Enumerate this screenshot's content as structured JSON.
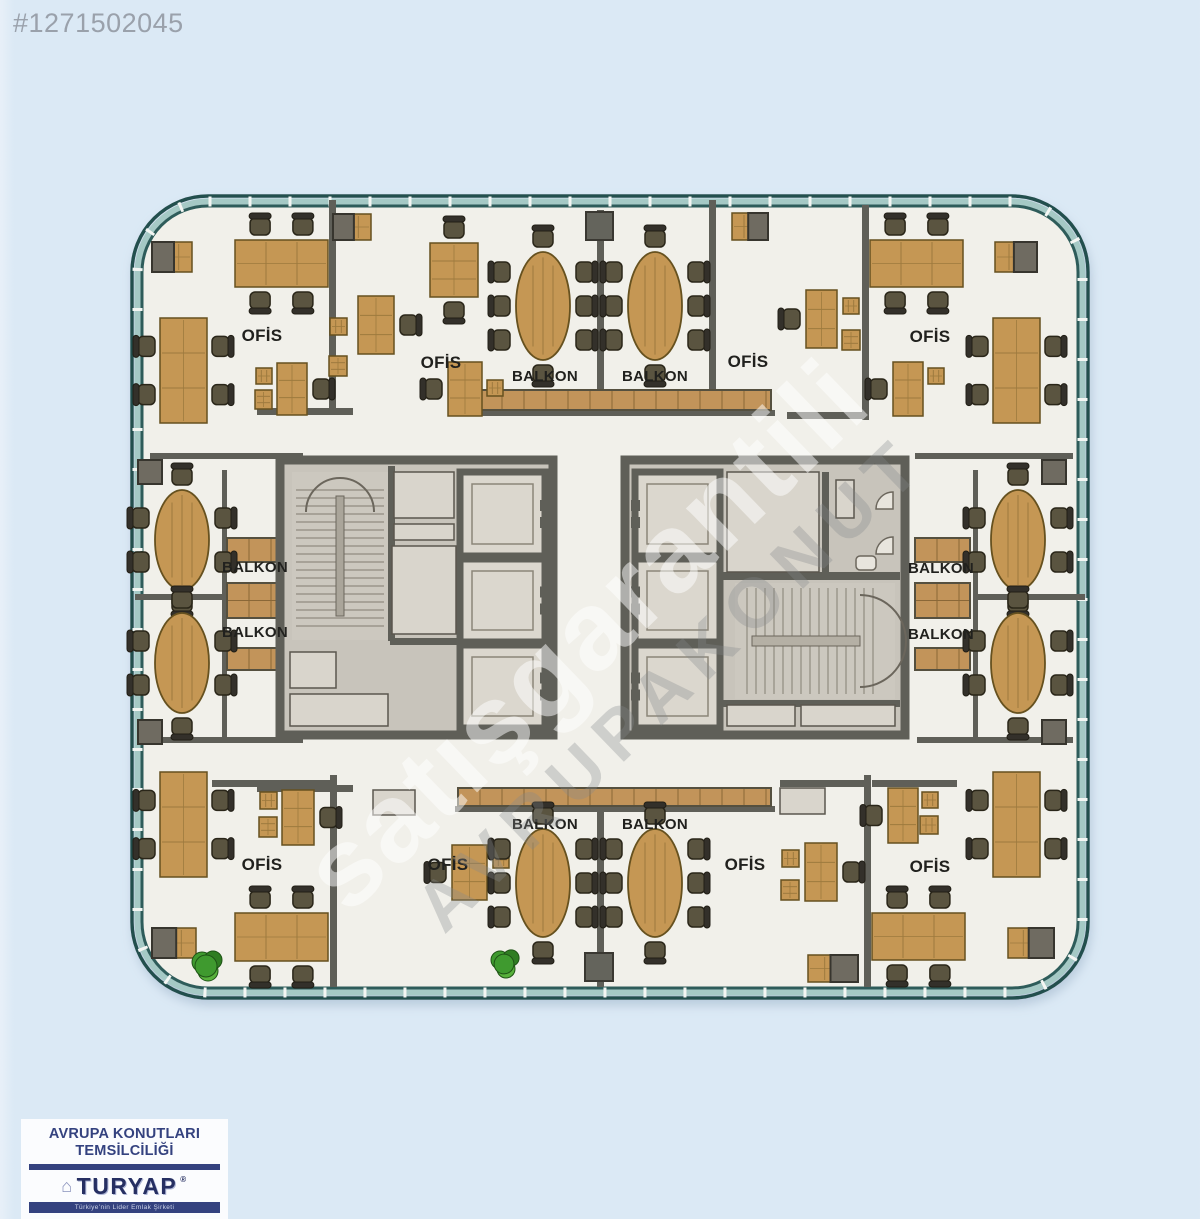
{
  "listing_id": "#1271502045",
  "watermark": {
    "line1": "satışgarantili",
    "line2": "AVRUPAKONUT"
  },
  "logo": {
    "line1": "AVRUPA KONUTLARI",
    "line2": "TEMSİLCİLİĞİ",
    "brand": "TURYAP",
    "reg": "®",
    "tagline": "Türkiye'nin Lider Emlak Şirketi"
  },
  "colors": {
    "page_bg": "#dbe9f5",
    "floor": "#f1f0ea",
    "wall": "#5f5f58",
    "facade_dark": "#24504e",
    "facade_glass": "#a5c9c5",
    "tick": "#f4f6f3",
    "wood": "#c59754",
    "wood_line": "#9d7a3e",
    "chair": "#5a5440",
    "core_fill": "#c8c4bb",
    "cabin_fill": "#dbd7ce",
    "panel": "#d9d5cc",
    "label_ink": "#21211e",
    "id_gray": "#9aa1ab",
    "logo_navy": "#34427f",
    "plant_green": "#3f9a2f"
  },
  "plan": {
    "labels": [
      {
        "text": "OFİS",
        "x": 262,
        "y": 341,
        "kind": "ofis"
      },
      {
        "text": "OFİS",
        "x": 441,
        "y": 368,
        "kind": "ofis"
      },
      {
        "text": "OFİS",
        "x": 748,
        "y": 367,
        "kind": "ofis"
      },
      {
        "text": "OFİS",
        "x": 930,
        "y": 342,
        "kind": "ofis"
      },
      {
        "text": "OFİS",
        "x": 262,
        "y": 870,
        "kind": "ofis"
      },
      {
        "text": "OFİS",
        "x": 448,
        "y": 870,
        "kind": "ofis"
      },
      {
        "text": "OFİS",
        "x": 745,
        "y": 870,
        "kind": "ofis"
      },
      {
        "text": "OFİS",
        "x": 930,
        "y": 872,
        "kind": "ofis"
      },
      {
        "text": "BALKON",
        "x": 545,
        "y": 381,
        "kind": "balkon"
      },
      {
        "text": "BALKON",
        "x": 655,
        "y": 381,
        "kind": "balkon"
      },
      {
        "text": "BALKON",
        "x": 255,
        "y": 572,
        "kind": "balkon"
      },
      {
        "text": "BALKON",
        "x": 255,
        "y": 637,
        "kind": "balkon"
      },
      {
        "text": "BALKON",
        "x": 941,
        "y": 573,
        "kind": "balkon"
      },
      {
        "text": "BALKON",
        "x": 941,
        "y": 639,
        "kind": "balkon"
      },
      {
        "text": "BALKON",
        "x": 545,
        "y": 829,
        "kind": "balkon"
      },
      {
        "text": "BALKON",
        "x": 655,
        "y": 829,
        "kind": "balkon"
      }
    ],
    "walls": [
      [
        329,
        200,
        7,
        213
      ],
      [
        257,
        408,
        96,
        7
      ],
      [
        597,
        210,
        7,
        182
      ],
      [
        709,
        200,
        7,
        190
      ],
      [
        862,
        205,
        7,
        215
      ],
      [
        455,
        410,
        320,
        6
      ],
      [
        787,
        412,
        80,
        7
      ],
      [
        150,
        453,
        153,
        6
      ],
      [
        915,
        453,
        158,
        6
      ],
      [
        222,
        470,
        5,
        267
      ],
      [
        973,
        470,
        5,
        267
      ],
      [
        135,
        594,
        90,
        6
      ],
      [
        975,
        594,
        110,
        6
      ],
      [
        150,
        737,
        153,
        6
      ],
      [
        917,
        737,
        156,
        6
      ],
      [
        330,
        775,
        7,
        212
      ],
      [
        257,
        785,
        96,
        7
      ],
      [
        597,
        812,
        7,
        175
      ],
      [
        864,
        775,
        7,
        212
      ],
      [
        455,
        806,
        320,
        6
      ],
      [
        780,
        780,
        85,
        7
      ],
      [
        212,
        780,
        121,
        7
      ],
      [
        872,
        780,
        85,
        7
      ]
    ],
    "strips": [
      {
        "x": 458,
        "y": 390,
        "w": 313,
        "h": 20
      },
      {
        "x": 458,
        "y": 788,
        "w": 313,
        "h": 18
      },
      {
        "x": 227,
        "y": 538,
        "w": 52,
        "h": 24
      },
      {
        "x": 227,
        "y": 583,
        "w": 52,
        "h": 35
      },
      {
        "x": 227,
        "y": 648,
        "w": 52,
        "h": 22
      },
      {
        "x": 915,
        "y": 538,
        "w": 55,
        "h": 24
      },
      {
        "x": 915,
        "y": 583,
        "w": 55,
        "h": 35
      },
      {
        "x": 915,
        "y": 648,
        "w": 55,
        "h": 22
      }
    ],
    "columns": [
      [
        586,
        212,
        27,
        28
      ],
      [
        585,
        953,
        28,
        28
      ]
    ],
    "door_gaps": [
      [
        424,
        454,
        26,
        12
      ],
      [
        424,
        729,
        26,
        12
      ],
      [
        758,
        454,
        26,
        12
      ],
      [
        758,
        729,
        26,
        12
      ]
    ],
    "cores": {
      "left": {
        "outer": [
          280,
          460,
          273,
          275
        ],
        "stair": {
          "x": 292,
          "y": 472,
          "w": 96,
          "h": 168,
          "dir": "h"
        },
        "cabins": [
          [
            460,
            472,
            85,
            84
          ],
          [
            460,
            559,
            85,
            83
          ],
          [
            460,
            645,
            85,
            83
          ]
        ],
        "door_side": "right",
        "iwalls": [
          [
            388,
            466,
            7,
            175
          ],
          [
            390,
            638,
            100,
            7
          ]
        ],
        "panels": [
          [
            394,
            472,
            60,
            46
          ],
          [
            394,
            524,
            60,
            16
          ],
          [
            392,
            546,
            64,
            88
          ],
          [
            290,
            652,
            46,
            36
          ],
          [
            290,
            694,
            98,
            32
          ]
        ]
      },
      "right": {
        "outer": [
          625,
          460,
          280,
          275
        ],
        "stair": {
          "x": 735,
          "y": 583,
          "w": 160,
          "h": 116,
          "dir": "v"
        },
        "cabins": [
          [
            635,
            472,
            85,
            84
          ],
          [
            635,
            559,
            85,
            83
          ],
          [
            635,
            645,
            85,
            83
          ]
        ],
        "door_side": "left",
        "iwalls": [
          [
            722,
            572,
            178,
            8
          ],
          [
            722,
            700,
            178,
            7
          ],
          [
            822,
            472,
            7,
            105
          ]
        ],
        "panels": [
          [
            727,
            472,
            92,
            100
          ],
          [
            727,
            705,
            68,
            21
          ],
          [
            801,
            705,
            94,
            21
          ],
          [
            836,
            480,
            18,
            38
          ]
        ],
        "wc": {
          "sinks": [
            [
              893,
              492
            ],
            [
              893,
              537
            ]
          ],
          "toilet": [
            856,
            556,
            20,
            14
          ]
        }
      }
    },
    "furniture": [
      {
        "t": "cabwood",
        "x": 152,
        "y": 242,
        "w": 40,
        "h": 30,
        "gray": "left"
      },
      {
        "t": "tableh",
        "x": 235,
        "y": 240,
        "w": 93,
        "h": 47,
        "nc": 4
      },
      {
        "t": "tablev",
        "x": 160,
        "y": 318,
        "w": 47,
        "h": 105,
        "nc": 4
      },
      {
        "t": "deskv",
        "x": 277,
        "y": 363,
        "w": 30,
        "h": 52,
        "chair": "right"
      },
      {
        "t": "sq",
        "x": 256,
        "y": 368,
        "w": 16,
        "h": 16
      },
      {
        "t": "sq",
        "x": 255,
        "y": 390,
        "w": 17,
        "h": 19
      },
      {
        "t": "cabwood",
        "x": 333,
        "y": 214,
        "w": 38,
        "h": 26,
        "gray": "left"
      },
      {
        "t": "deskv",
        "x": 358,
        "y": 296,
        "w": 36,
        "h": 58,
        "chair": "right"
      },
      {
        "t": "sq",
        "x": 330,
        "y": 318,
        "w": 17,
        "h": 17
      },
      {
        "t": "sq",
        "x": 329,
        "y": 356,
        "w": 18,
        "h": 20
      },
      {
        "t": "tableh",
        "x": 430,
        "y": 243,
        "w": 48,
        "h": 54,
        "nc": 2
      },
      {
        "t": "deskv",
        "x": 448,
        "y": 362,
        "w": 34,
        "h": 54,
        "chair": "left"
      },
      {
        "t": "sq",
        "x": 487,
        "y": 380,
        "w": 16,
        "h": 16
      },
      {
        "t": "oval",
        "cx": 543,
        "cy": 306,
        "rx": 27,
        "ry": 54,
        "nc": 8
      },
      {
        "t": "oval",
        "cx": 655,
        "cy": 306,
        "rx": 27,
        "ry": 54,
        "nc": 8
      },
      {
        "t": "cabwood",
        "x": 732,
        "y": 213,
        "w": 36,
        "h": 27,
        "gray": "right"
      },
      {
        "t": "deskv",
        "x": 806,
        "y": 290,
        "w": 31,
        "h": 58,
        "chair": "left"
      },
      {
        "t": "sq",
        "x": 843,
        "y": 298,
        "w": 16,
        "h": 16
      },
      {
        "t": "sq",
        "x": 842,
        "y": 330,
        "w": 18,
        "h": 20
      },
      {
        "t": "deskv",
        "x": 893,
        "y": 362,
        "w": 30,
        "h": 54,
        "chair": "left"
      },
      {
        "t": "sq",
        "x": 928,
        "y": 368,
        "w": 16,
        "h": 16
      },
      {
        "t": "tableh",
        "x": 870,
        "y": 240,
        "w": 93,
        "h": 47,
        "nc": 4
      },
      {
        "t": "cabwood",
        "x": 995,
        "y": 242,
        "w": 42,
        "h": 30,
        "gray": "right"
      },
      {
        "t": "tablev",
        "x": 993,
        "y": 318,
        "w": 47,
        "h": 105,
        "nc": 4
      },
      {
        "t": "cab",
        "x": 138,
        "y": 460,
        "w": 24,
        "h": 24
      },
      {
        "t": "oval",
        "cx": 182,
        "cy": 540,
        "rx": 27,
        "ry": 50,
        "nc": 6
      },
      {
        "t": "oval",
        "cx": 182,
        "cy": 663,
        "rx": 27,
        "ry": 50,
        "nc": 6
      },
      {
        "t": "cab",
        "x": 138,
        "y": 720,
        "w": 24,
        "h": 24
      },
      {
        "t": "cab",
        "x": 1042,
        "y": 460,
        "w": 24,
        "h": 24
      },
      {
        "t": "oval",
        "cx": 1018,
        "cy": 540,
        "rx": 27,
        "ry": 50,
        "nc": 6
      },
      {
        "t": "oval",
        "cx": 1018,
        "cy": 663,
        "rx": 27,
        "ry": 50,
        "nc": 6
      },
      {
        "t": "cab",
        "x": 1042,
        "y": 720,
        "w": 24,
        "h": 24
      },
      {
        "t": "tablev",
        "x": 160,
        "y": 772,
        "w": 47,
        "h": 105,
        "nc": 4
      },
      {
        "t": "deskv",
        "x": 282,
        "y": 790,
        "w": 32,
        "h": 55,
        "chair": "right"
      },
      {
        "t": "sq",
        "x": 260,
        "y": 792,
        "w": 17,
        "h": 17
      },
      {
        "t": "sq",
        "x": 259,
        "y": 817,
        "w": 18,
        "h": 20
      },
      {
        "t": "tableh",
        "x": 235,
        "y": 913,
        "w": 93,
        "h": 48,
        "nc": 4
      },
      {
        "t": "cabwood",
        "x": 152,
        "y": 928,
        "w": 44,
        "h": 30,
        "gray": "left"
      },
      {
        "t": "plant",
        "cx": 208,
        "cy": 966,
        "r": 20
      },
      {
        "t": "panel",
        "x": 373,
        "y": 790,
        "w": 42,
        "h": 25
      },
      {
        "t": "deskv",
        "x": 452,
        "y": 845,
        "w": 35,
        "h": 55,
        "chair": "left"
      },
      {
        "t": "sq",
        "x": 493,
        "y": 852,
        "w": 16,
        "h": 16
      },
      {
        "t": "oval",
        "cx": 543,
        "cy": 883,
        "rx": 27,
        "ry": 54,
        "nc": 8
      },
      {
        "t": "plant",
        "cx": 506,
        "cy": 964,
        "r": 18
      },
      {
        "t": "oval",
        "cx": 655,
        "cy": 883,
        "rx": 27,
        "ry": 54,
        "nc": 8
      },
      {
        "t": "panel",
        "x": 780,
        "y": 788,
        "w": 45,
        "h": 26
      },
      {
        "t": "deskv",
        "x": 805,
        "y": 843,
        "w": 32,
        "h": 58,
        "chair": "right"
      },
      {
        "t": "sq",
        "x": 782,
        "y": 850,
        "w": 17,
        "h": 17
      },
      {
        "t": "sq",
        "x": 781,
        "y": 880,
        "w": 18,
        "h": 20
      },
      {
        "t": "deskv",
        "x": 888,
        "y": 788,
        "w": 30,
        "h": 55,
        "chair": "left"
      },
      {
        "t": "sq",
        "x": 922,
        "y": 792,
        "w": 16,
        "h": 16
      },
      {
        "t": "sq",
        "x": 920,
        "y": 816,
        "w": 18,
        "h": 18
      },
      {
        "t": "cabwood",
        "x": 808,
        "y": 955,
        "w": 50,
        "h": 27,
        "gray": "right"
      },
      {
        "t": "tableh",
        "x": 872,
        "y": 913,
        "w": 93,
        "h": 47,
        "nc": 4
      },
      {
        "t": "tablev",
        "x": 993,
        "y": 772,
        "w": 47,
        "h": 105,
        "nc": 4
      },
      {
        "t": "cabwood",
        "x": 1008,
        "y": 928,
        "w": 46,
        "h": 30,
        "gray": "right"
      }
    ]
  }
}
